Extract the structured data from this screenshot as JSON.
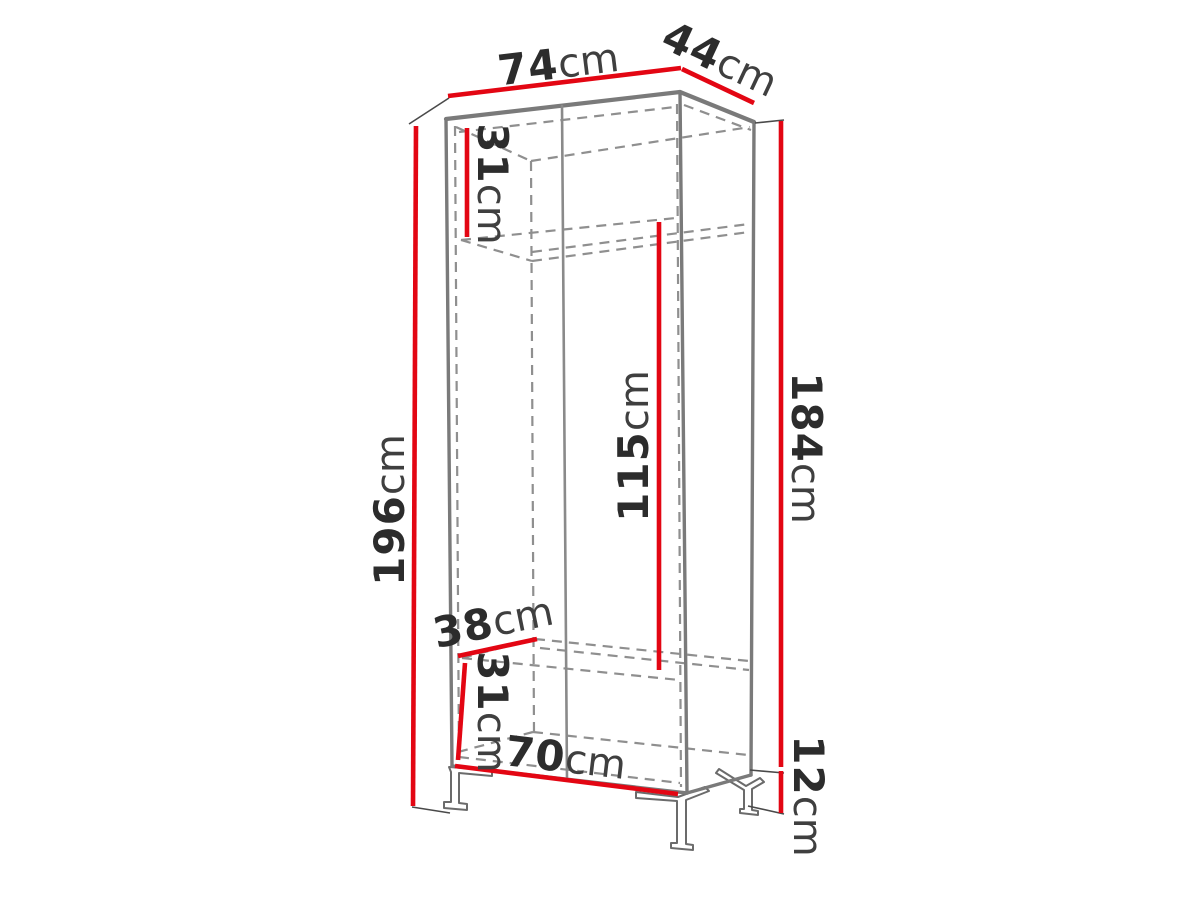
{
  "figure": {
    "type": "furniture-dimension-diagram",
    "subject": "two-door wardrobe on metal frame legs, perspective line drawing"
  },
  "colors": {
    "dimension_line": "#e30613",
    "structure_line": "#7a7a7a",
    "hidden_line": "#8f8f8f",
    "number_text": "#2c2c2c",
    "unit_text": "#3f3f3f",
    "background": "#ffffff"
  },
  "dimensions": {
    "width_top": {
      "value": "74",
      "unit": "cm"
    },
    "depth_top": {
      "value": "44",
      "unit": "cm"
    },
    "height_total": {
      "value": "196",
      "unit": "cm"
    },
    "top_compartment": {
      "value": "31",
      "unit": "cm"
    },
    "hanging_space": {
      "value": "115",
      "unit": "cm"
    },
    "carcass_height": {
      "value": "184",
      "unit": "cm"
    },
    "shelf_depth": {
      "value": "38",
      "unit": "cm"
    },
    "bottom_compartment": {
      "value": "31",
      "unit": "cm"
    },
    "width_bottom": {
      "value": "70",
      "unit": "cm"
    },
    "leg_height": {
      "value": "12",
      "unit": "cm"
    }
  }
}
